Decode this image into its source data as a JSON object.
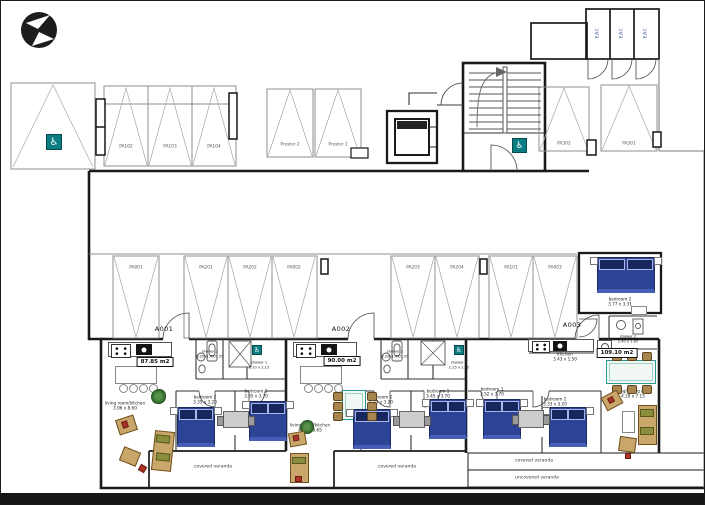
{
  "icons": {
    "wheelchair": "♿"
  },
  "closets": {
    "labels": [
      "EAC",
      "EAC",
      "EAC"
    ]
  },
  "parking": {
    "bank_a": {
      "stalls": [
        "PA102",
        "PA103",
        "PA104"
      ]
    },
    "bank_mid": {
      "stalls": [
        "Prostor 2",
        "Prostor 1"
      ]
    },
    "bank_right": {
      "stalls": [
        "PA302",
        "PA301"
      ]
    },
    "row_left": {
      "stalls": [
        "PA001",
        "PA201",
        "PA202",
        "PA002"
      ]
    },
    "row_right": {
      "stalls": [
        "PA203",
        "PA204",
        "PA101",
        "PA003"
      ]
    }
  },
  "units": {
    "a001": {
      "id": "A001",
      "area": "87.85 m2",
      "living": {
        "name": "living room/kitchen",
        "dims": "3.96 x 8.60"
      },
      "shower2": {
        "name": "shower 2",
        "dims": "3.20x1.49/1.05"
      },
      "shower1": {
        "name": "shower 1",
        "dims": "2.10 x 2.15"
      },
      "bedroom2": {
        "name": "bedroom 2",
        "dims": "3.35 x 3.20"
      },
      "bedroom1": {
        "name": "bedroom 1",
        "dims": "3.35 x 3.70"
      },
      "veranda": "covered veranda"
    },
    "a002": {
      "id": "A002",
      "area": "90.00 m2",
      "living": {
        "name": "living room/kitchen",
        "dims": "4.23 x 8.65"
      },
      "shower2": {
        "name": "shower 2",
        "dims": "3.20x1.49/1.05"
      },
      "shower1": {
        "name": "shower 1",
        "dims": "2.25 x 2.15"
      },
      "bedroom2": {
        "name": "bedroom 2",
        "dims": "3.35 x 3.20"
      },
      "bedroom1": {
        "name": "bedroom 1",
        "dims": "3.45 x 3.70"
      },
      "veranda": "covered veranda"
    },
    "a003": {
      "id": "A003",
      "area": "109.10 m2",
      "kitchen": {
        "name": "kitchen",
        "dims": "3.43 x 1.50"
      },
      "bedroom2_top": {
        "name": "bedroom 2",
        "dims": "3.77 x 3.31"
      },
      "shower2": {
        "name": "shower 2",
        "dims": "2.40 x 1.65"
      },
      "living": {
        "name": "living/dining room",
        "dims": "4.28 x 7.15"
      },
      "bedroom1": {
        "name": "bedroom 1",
        "dims": "3.52 x 3.70"
      },
      "bedroom2": {
        "name": "bedroom 2",
        "dims": "3.33 x 3.20"
      },
      "veranda_covered": "covered veranda",
      "veranda_uncovered": "uncovered veranda"
    }
  }
}
